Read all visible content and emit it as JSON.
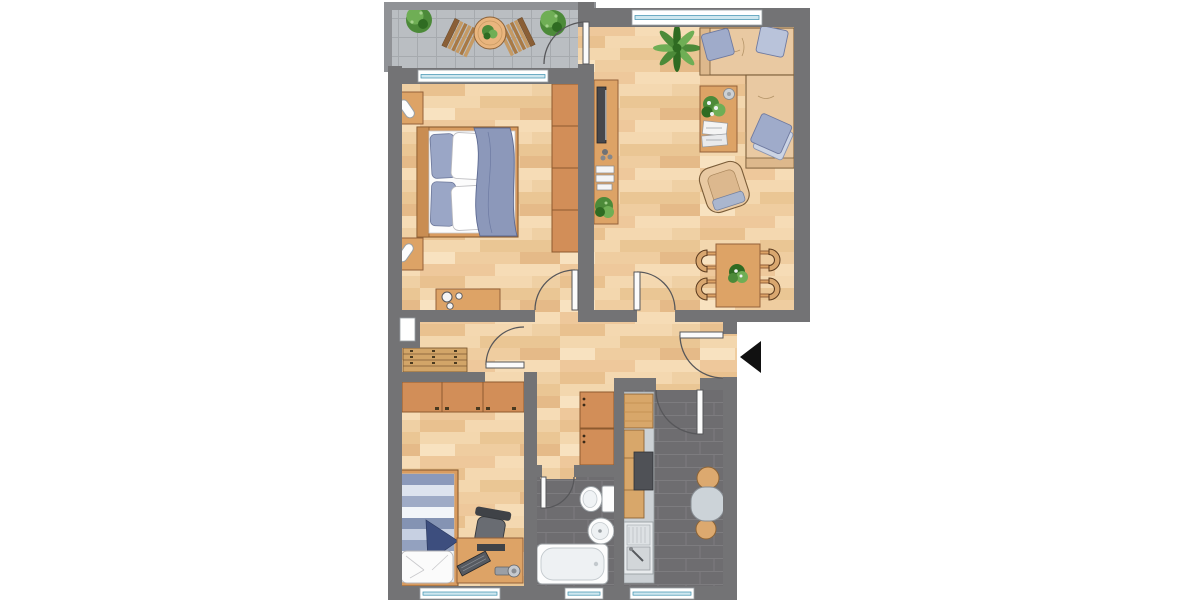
{
  "meta": {
    "type": "architectural-floor-plan",
    "view": "top-down furnished color plan",
    "canvas": {
      "width": 1200,
      "height": 600
    }
  },
  "palette": {
    "background": "#ffffff",
    "wall": "#737375",
    "balcony_wall": "#909296",
    "wood_floor": "#f3d6ae",
    "balcony_tile": "#babec2",
    "dark_tile": "#6e6d70",
    "tile_grout": "#7d7c7f",
    "furniture_wood": "#dda366",
    "furniture_wood_dark": "#94613a",
    "wardrobe": "#d28e58",
    "fixture_white": "#fdfdfd",
    "fixture_stroke": "#9aa0a4",
    "counter_gray": "#ccd1d5",
    "textile_blue": "#8f9cbd",
    "textile_blue_light": "#ccd4e4",
    "textile_navy": "#3d4e7e",
    "plant_green": "#4c8a39",
    "plant_green_light": "#6fae55",
    "window_glass": "#cfe7ef",
    "window_line": "#3a8fae",
    "door_stroke": "#57575a",
    "entrance_arrow": "#111111"
  },
  "rooms": [
    {
      "name": "balcony",
      "floor": "gray-tile",
      "items": [
        "potted-shrub",
        "potted-shrub",
        "bistro-table",
        "table-plant",
        "deck-chair",
        "deck-chair"
      ]
    },
    {
      "name": "living-room",
      "floor": "wood",
      "items": [
        "corner-sofa",
        "cushion",
        "cushion",
        "cushion",
        "palm-plant",
        "coffee-table",
        "flower-bouquet",
        "magazines",
        "round-bowl",
        "armchair",
        "tv-sideboard",
        "tv",
        "stereo-boxes",
        "potted-plant",
        "dining-table",
        "table-plant",
        "dining-chair",
        "dining-chair",
        "dining-chair",
        "dining-chair"
      ]
    },
    {
      "name": "bedroom",
      "floor": "wood",
      "items": [
        "double-bed",
        "pillows",
        "blanket",
        "nightstand",
        "nightstand",
        "table-lamp",
        "table-lamp",
        "wardrobe",
        "dresser"
      ]
    },
    {
      "name": "hallway",
      "floor": "wood",
      "items": [
        "shoe-bench",
        "wall-niche-window",
        "hall-closet",
        "entrance-door",
        "entrance-arrow"
      ]
    },
    {
      "name": "small-bedroom",
      "floor": "wood",
      "items": [
        "wardrobe",
        "single-bed",
        "pillow",
        "blanket",
        "desk",
        "office-chair",
        "monitor",
        "keyboard",
        "desk-lamp"
      ]
    },
    {
      "name": "bathroom",
      "floor": "dark-tile",
      "items": [
        "toilet",
        "washbasin",
        "bathtub"
      ]
    },
    {
      "name": "kitchen",
      "floor": "dark-tile",
      "items": [
        "kitchen-counter",
        "upper-cabinet",
        "base-cabinets",
        "stove",
        "kitchen-sink",
        "wall-table",
        "stool",
        "stool"
      ]
    }
  ],
  "openings": {
    "windows": 7,
    "interior_doors": 6,
    "entrance_doors": 1,
    "entrance_marker": "black-arrow-pointing-left-into-apartment"
  }
}
